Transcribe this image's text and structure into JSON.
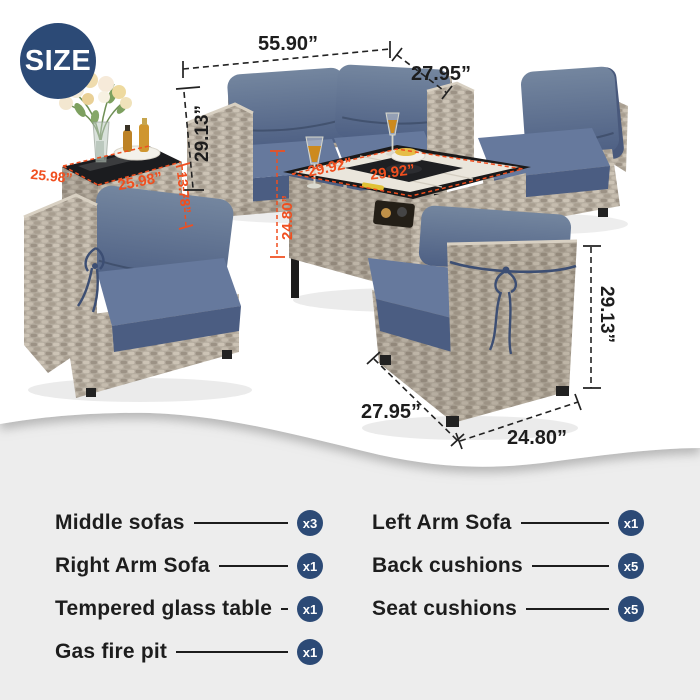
{
  "size_badge": {
    "label": "SIZE"
  },
  "dimensions": {
    "loveseat_width": "55.90”",
    "loveseat_depth": "27.95”",
    "loveseat_height": "29.13”",
    "side_table_width": "25.98”",
    "side_table_depth": "25.98”",
    "side_table_height": "13.78”",
    "fire_table_width": "29.92”",
    "fire_table_depth": "29.92”",
    "fire_table_height": "24.80”",
    "sofa_depth": "27.95”",
    "sofa_width": "24.80”",
    "sofa_height": "29.13”"
  },
  "colors": {
    "navy": "#2c4a76",
    "orange": "#f04f1f",
    "cushion_blue": "#5d7094",
    "wicker": "#b4ab9e",
    "panel_gray": "#ededed"
  },
  "items": {
    "left": [
      {
        "label": "Middle sofas",
        "count": "x3"
      },
      {
        "label": "Right Arm Sofa",
        "count": "x1"
      },
      {
        "label": "Tempered glass table",
        "count": "x1"
      },
      {
        "label": "Gas fire pit",
        "count": "x1"
      }
    ],
    "right": [
      {
        "label": "Left Arm Sofa",
        "count": "x1"
      },
      {
        "label": "Back cushions",
        "count": "x5"
      },
      {
        "label": "Seat cushions",
        "count": "x5"
      }
    ]
  }
}
